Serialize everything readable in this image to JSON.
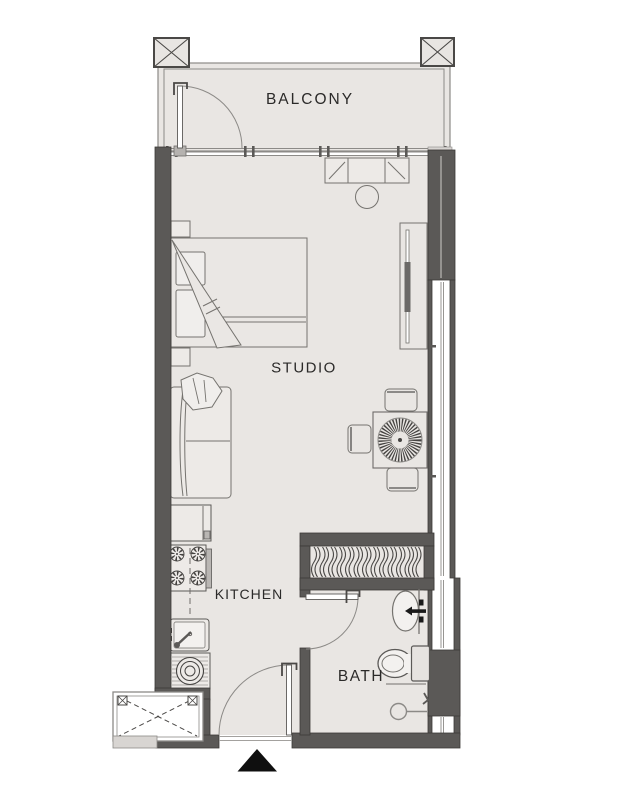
{
  "rooms": {
    "balcony": {
      "label": "BALCONY"
    },
    "studio": {
      "label": "STUDIO"
    },
    "kitchen": {
      "label": "KITCHEN"
    },
    "bath": {
      "label": "BATH"
    }
  },
  "colors": {
    "wall": "#5b5957",
    "floor": "#e9e6e3",
    "furniture_outline": "#75736f",
    "railing": "#8c8a87",
    "text": "#2b2a29",
    "entrance_marker": "#0f0f0f",
    "background": "#ffffff"
  },
  "symbols": [
    "column-marker",
    "balcony-door",
    "sliding-window-wall",
    "bed",
    "pillow",
    "nightstand",
    "blanket",
    "sofa",
    "throw-blanket",
    "fridge",
    "stove",
    "kitchen-sink",
    "washing-machine",
    "service-shaft",
    "entrance-door",
    "entrance-arrow",
    "dining-table",
    "dining-chair",
    "tv-unit",
    "dresser",
    "stool",
    "wardrobe-hangers",
    "bath-door",
    "bath-sink",
    "toilet",
    "shower-head",
    "window-glazing"
  ]
}
